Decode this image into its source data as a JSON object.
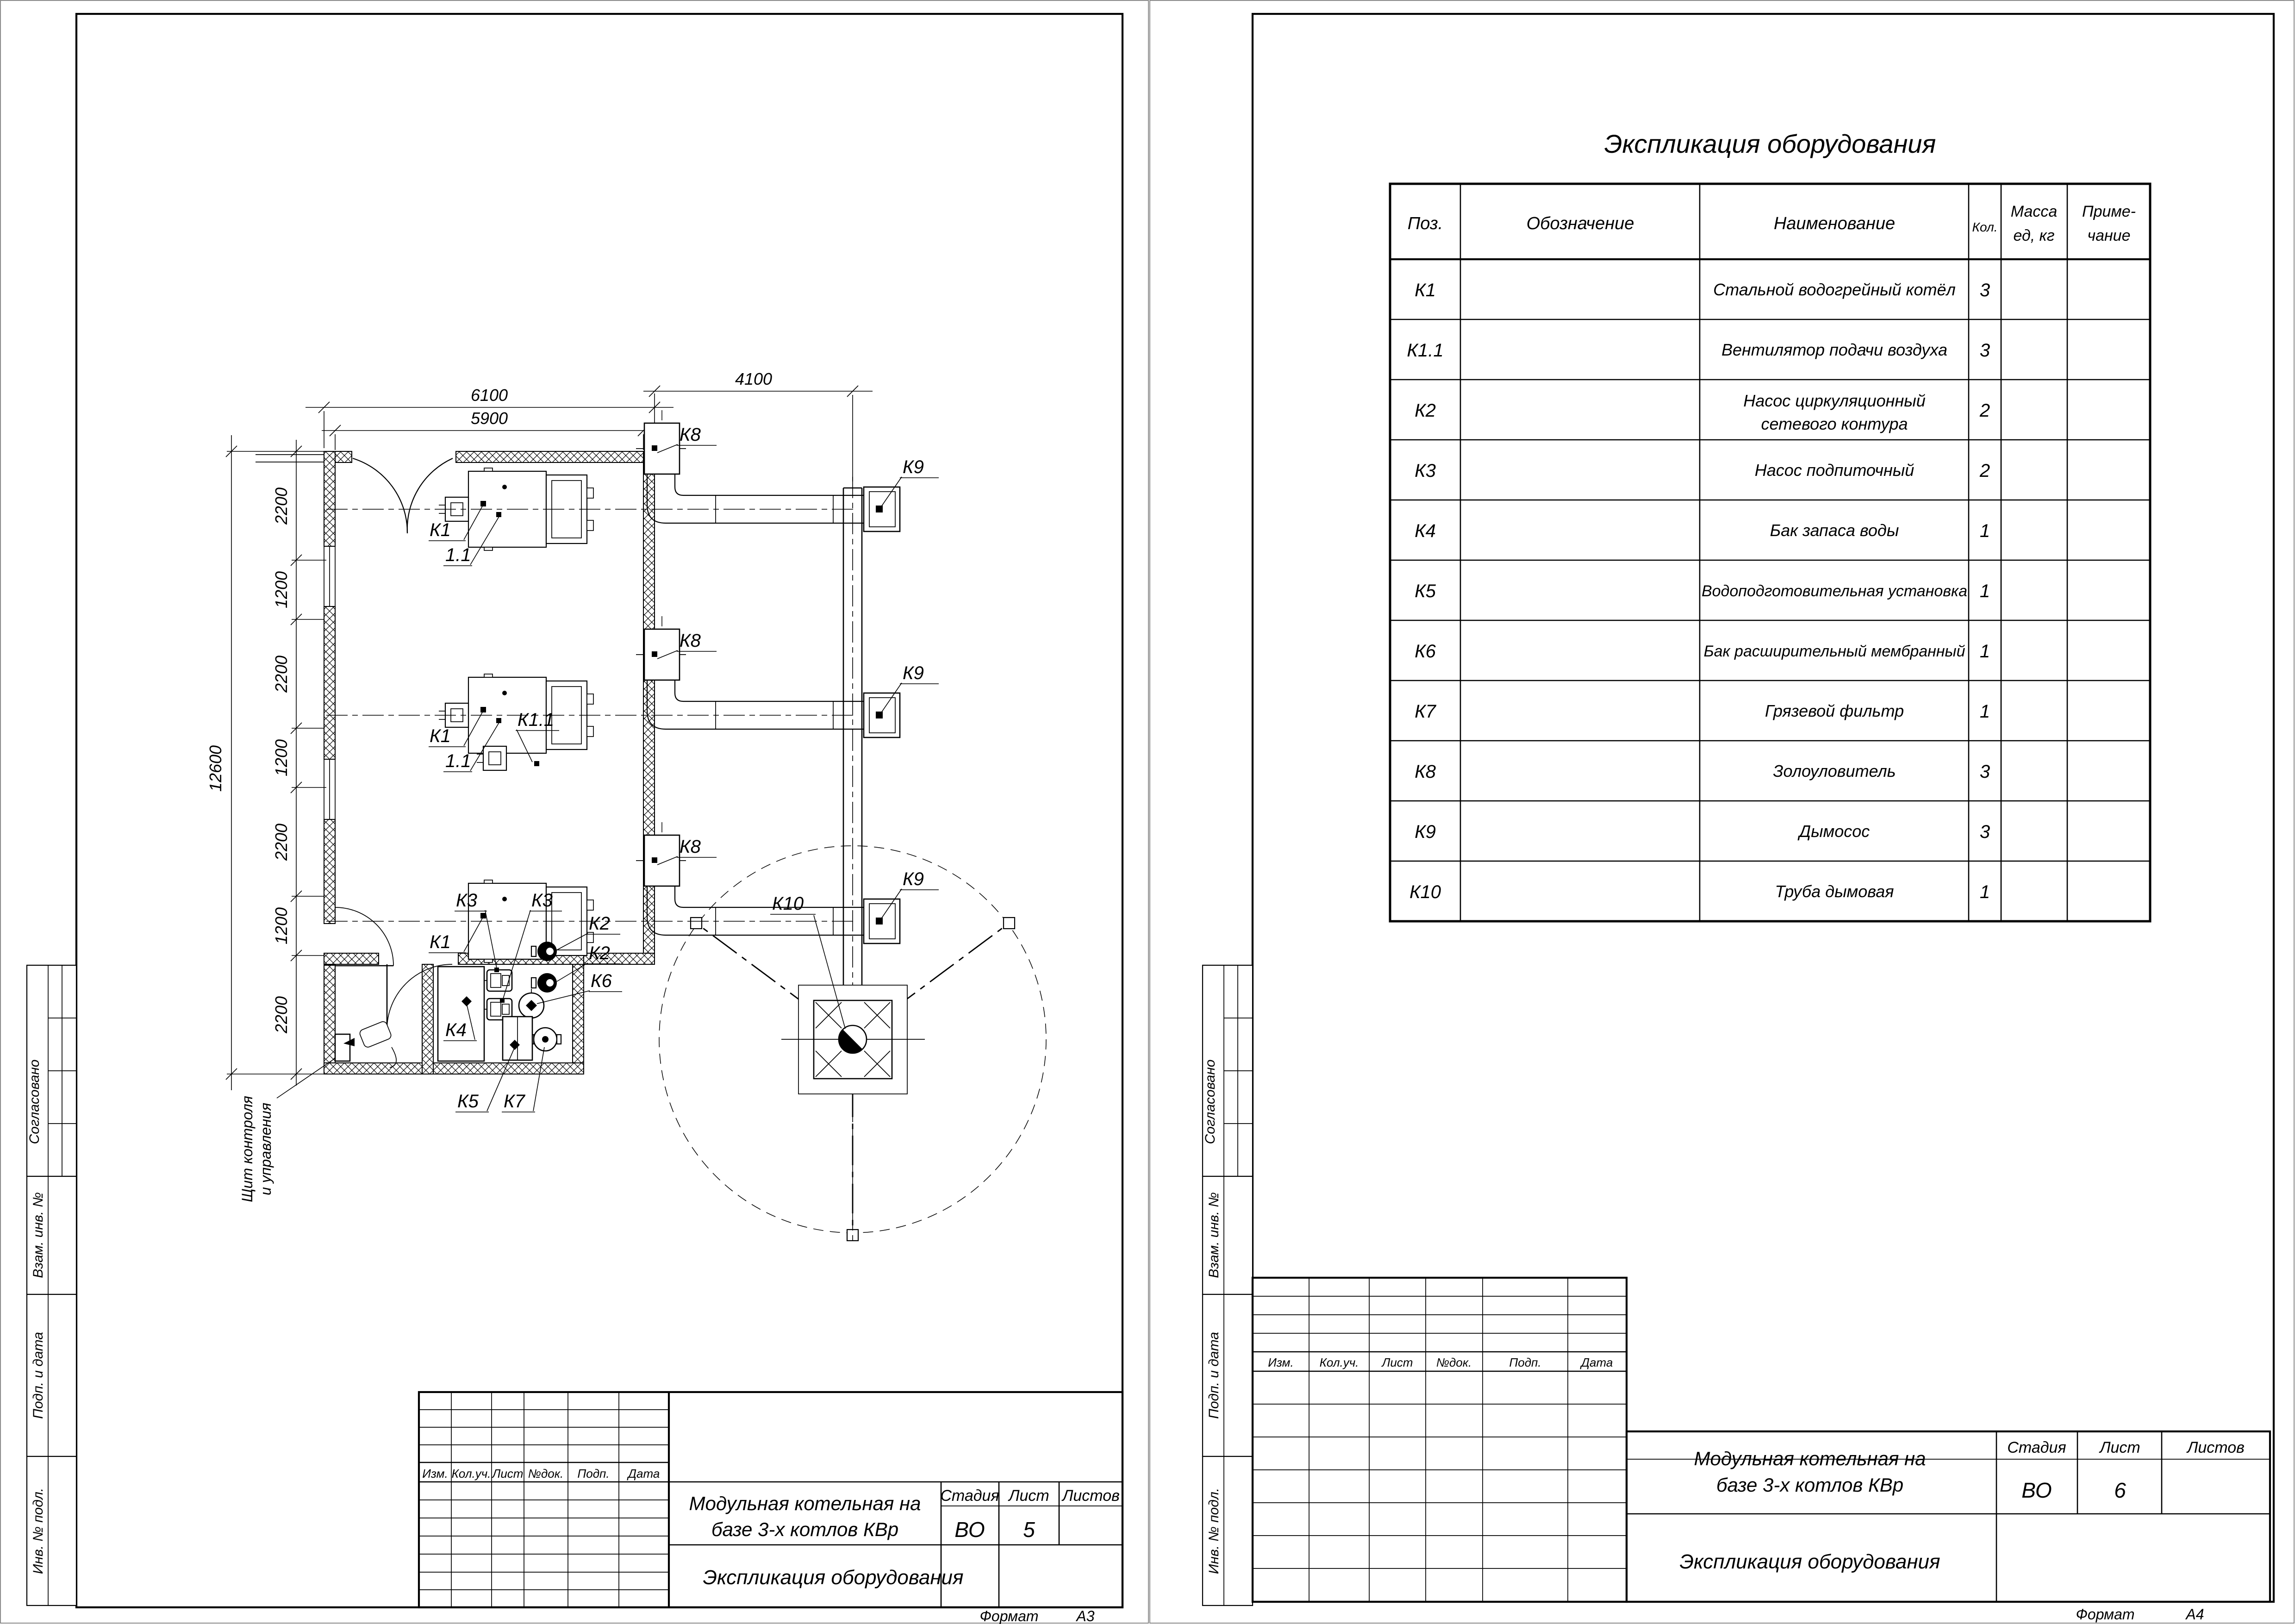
{
  "drawing": {
    "table": {
      "title": "Экспликация оборудования",
      "headers": {
        "pos": "Поз.",
        "designation": "Обозначение",
        "name": "Наименование",
        "qty": "Кол.",
        "mass1": "Масса",
        "mass2": "ед, кг",
        "note1": "Приме-",
        "note2": "чание"
      },
      "rows": [
        {
          "pos": "К1",
          "name": "Стальной водогрейный котёл",
          "qty": "3"
        },
        {
          "pos": "К1.1",
          "name": "Вентилятор подачи воздуха",
          "qty": "3"
        },
        {
          "pos": "К2",
          "name": "Насос циркуляционный",
          "name2": "сетевого контура",
          "qty": "2"
        },
        {
          "pos": "К3",
          "name": "Насос подпиточный",
          "qty": "2"
        },
        {
          "pos": "К4",
          "name": "Бак запаса воды",
          "qty": "1"
        },
        {
          "pos": "К5",
          "name": "Водоподготовительная установка",
          "qty": "1"
        },
        {
          "pos": "К6",
          "name": "Бак расширительный мембранный",
          "qty": "1"
        },
        {
          "pos": "К7",
          "name": "Грязевой фильтр",
          "qty": "1"
        },
        {
          "pos": "К8",
          "name": "Золоуловитель",
          "qty": "3"
        },
        {
          "pos": "К9",
          "name": "Дымосос",
          "qty": "3"
        },
        {
          "pos": "К10",
          "name": "Труба дымовая",
          "qty": "1"
        }
      ]
    },
    "stamp": {
      "doc_title_l1": "Модульная котельная на",
      "doc_title_l2": "базе 3-х котлов КВр",
      "doc_type": "Экспликация оборудования",
      "stage_label": "Стадия",
      "sheet_label": "Лист",
      "sheets_label": "Листов",
      "stage": "ВО",
      "sheet_left": "5",
      "sheet_right": "6",
      "format_label": "Формат",
      "format_left": "А3",
      "format_right": "А4",
      "rev": [
        "Изм.",
        "Кол.уч.",
        "Лист",
        "№док.",
        "Подп.",
        "Дата"
      ]
    },
    "margins": [
      "Согласовано",
      "Взам. инв. №",
      "Подп. и дата",
      "Инв. № подл."
    ],
    "plan": {
      "dims": {
        "d6100": "6100",
        "d5900": "5900",
        "d4100": "4100",
        "d12600": "12600",
        "d2200": "2200",
        "d1200": "1200"
      },
      "labels": {
        "k1": "К1",
        "k1_1_short": "1.1",
        "k1_1": "К1.1",
        "k2": "К2",
        "k3": "К3",
        "k4": "К4",
        "k5": "К5",
        "k6": "К6",
        "k7": "К7",
        "k8": "К8",
        "k9": "К9",
        "k10": "К10"
      },
      "note_panel_l1": "Щит контроля",
      "note_panel_l2": "и управления"
    }
  }
}
